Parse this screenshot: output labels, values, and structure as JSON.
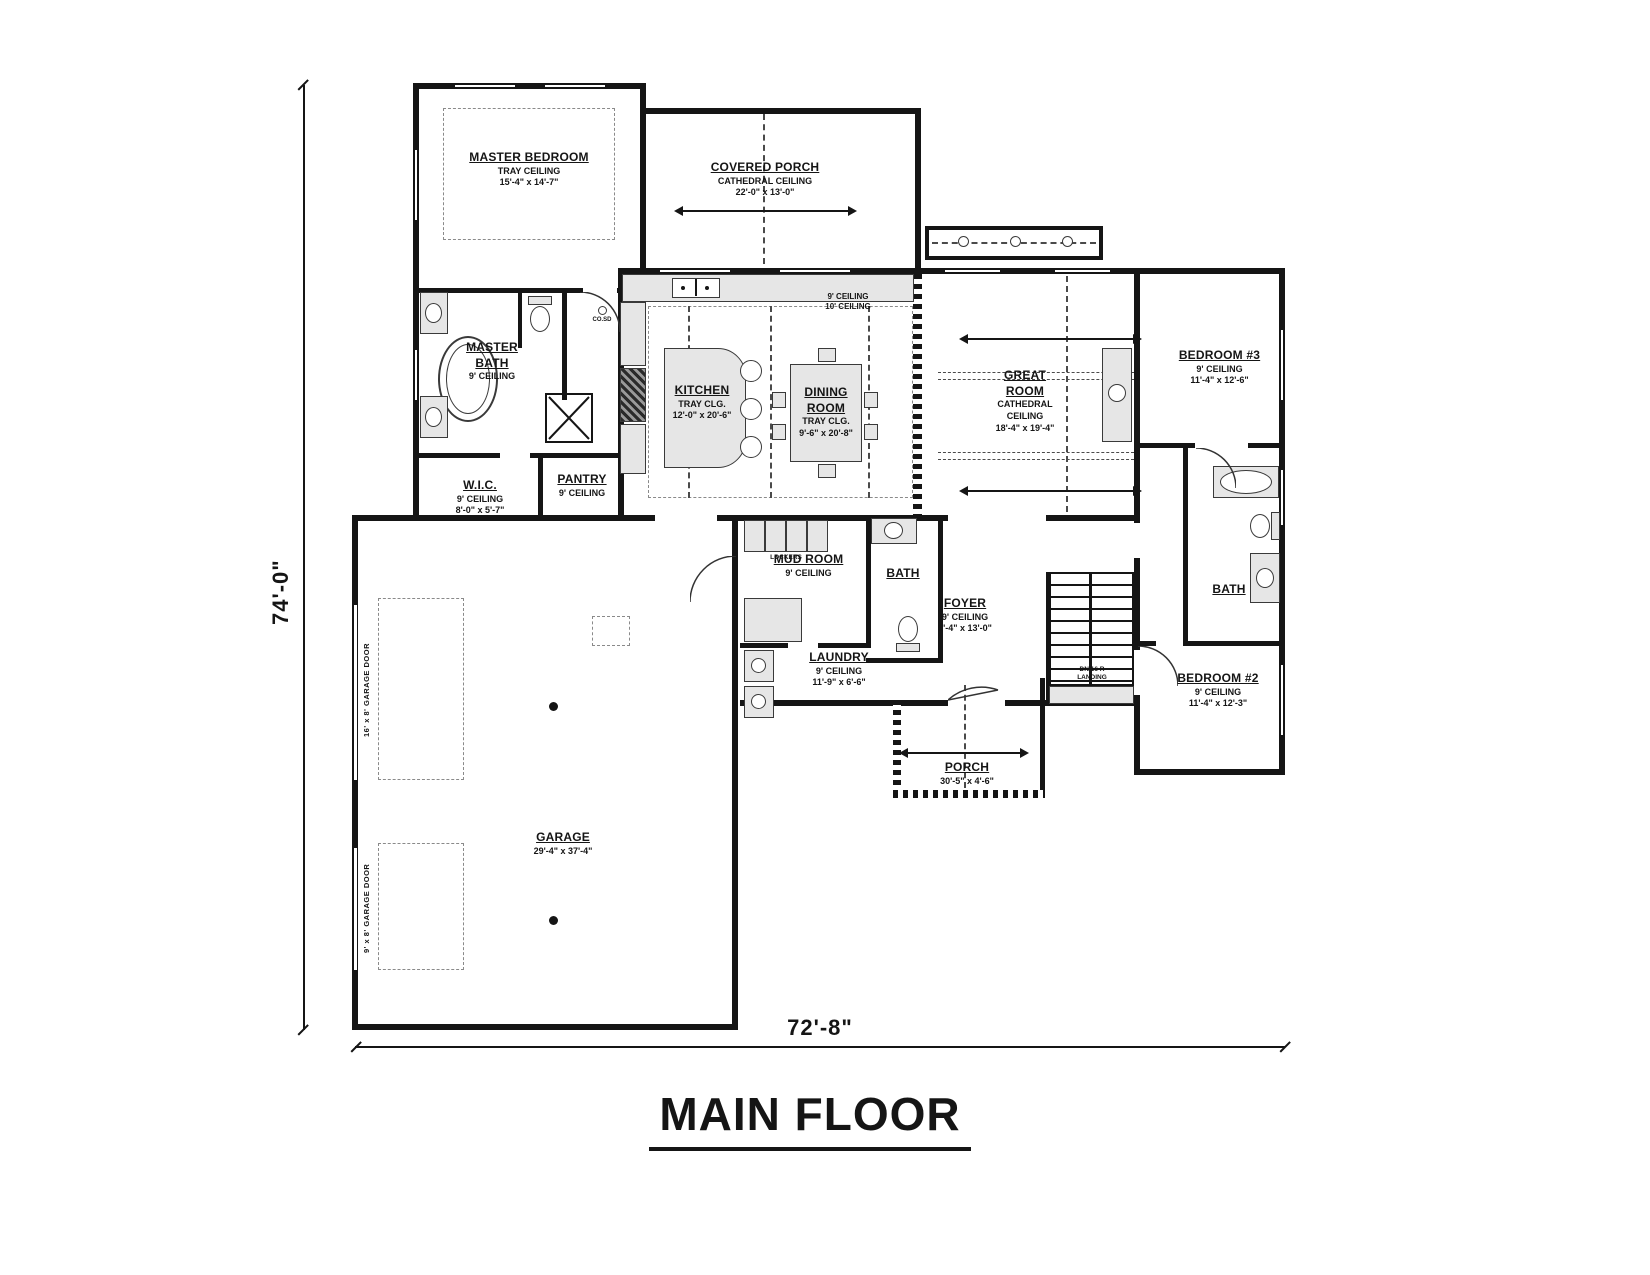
{
  "title": "MAIN FLOOR",
  "plan_dimensions": {
    "height_label": "74'-0\"",
    "width_label": "72'-8\""
  },
  "rooms": {
    "master_bedroom": {
      "name": "MASTER BEDROOM",
      "ceiling": "TRAY CEILING",
      "size": "15'-4\" x 14'-7\""
    },
    "covered_porch": {
      "name": "COVERED PORCH",
      "ceiling": "CATHEDRAL CEILING",
      "size": "22'-0\" x 13'-0\""
    },
    "master_bath": {
      "name": "MASTER BATH",
      "ceiling": "9' CEILING"
    },
    "wic": {
      "name": "W.I.C.",
      "ceiling": "9' CEILING",
      "size": "8'-0\" x 5'-7\""
    },
    "pantry": {
      "name": "PANTRY",
      "ceiling": "9' CEILING"
    },
    "kitchen": {
      "name": "KITCHEN",
      "ceiling": "TRAY CLG.",
      "size": "12'-0\" x 20'-6\""
    },
    "dining_room": {
      "name": "DINING ROOM",
      "ceiling": "TRAY CLG.",
      "size": "9'-6\" x 20'-8\""
    },
    "great_room": {
      "name": "GREAT ROOM",
      "ceiling": "CATHEDRAL CEILING",
      "size": "18'-4\" x 19'-4\""
    },
    "bedroom_3": {
      "name": "BEDROOM #3",
      "ceiling": "9' CEILING",
      "size": "11'-4\" x 12'-6\""
    },
    "bath_right": {
      "name": "BATH"
    },
    "bedroom_2": {
      "name": "BEDROOM #2",
      "ceiling": "9' CEILING",
      "size": "11'-4\" x 12'-3\""
    },
    "mud_room": {
      "name": "MUD ROOM",
      "ceiling": "9' CEILING"
    },
    "bath_hall": {
      "name": "BATH"
    },
    "laundry": {
      "name": "LAUNDRY",
      "ceiling": "9' CEILING",
      "size": "11'-9\" x 6'-6\""
    },
    "foyer": {
      "name": "FOYER",
      "ceiling": "9' CEILING",
      "size": "8'-4\" x 13'-0\""
    },
    "porch": {
      "name": "PORCH",
      "size": "30'-5\" x 4'-6\""
    },
    "garage": {
      "name": "GARAGE",
      "size": "29'-4\" x 37'-4\""
    }
  },
  "annotations": {
    "lockers": "LOCKERS",
    "stairs_dn": "DN 16 R",
    "stairs_landing": "LANDING",
    "co_sd": "CO.SD",
    "ceiling_note_a": "9' CEILING",
    "ceiling_note_b": "10' CEILING",
    "garage_door_large": "16' x 8' GARAGE DOOR",
    "garage_door_small": "9' x 8' GARAGE DOOR"
  },
  "colors": {
    "line": "#151515",
    "fixture_fill": "#e6e6e6",
    "dash": "#4a4a4a"
  }
}
